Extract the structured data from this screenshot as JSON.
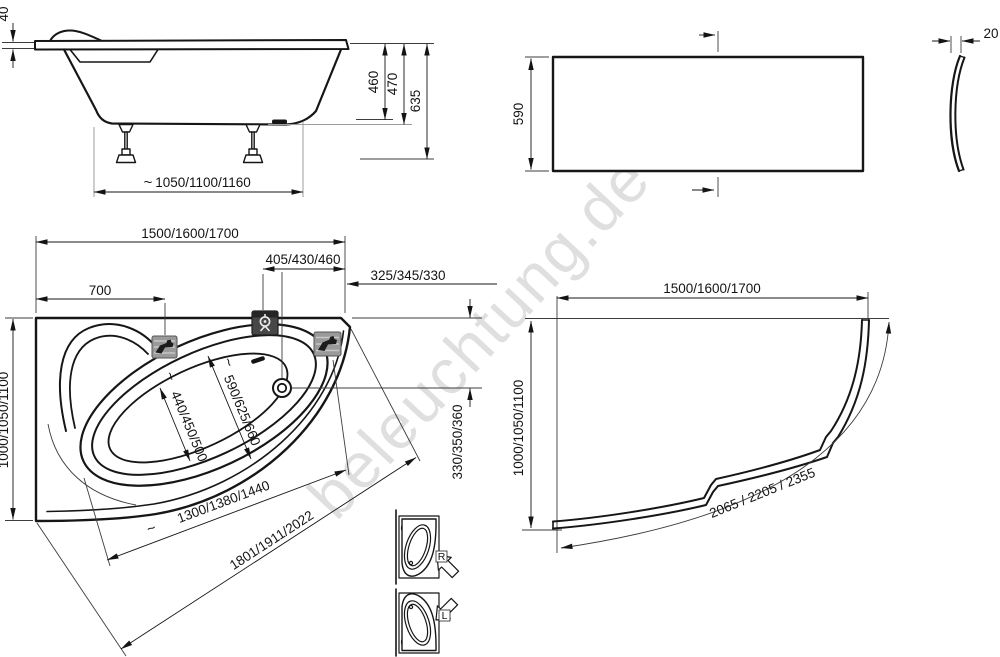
{
  "watermark": {
    "text": "beleuchtung.de"
  },
  "marks": {
    "approx": "~"
  },
  "side_view": {
    "rim_height": "40",
    "depth": "460",
    "shell_height": "470",
    "total_height": "635",
    "feet_span": "1050/1100/1160"
  },
  "front_panel": {
    "height": "590",
    "thickness": "20"
  },
  "top_view": {
    "length": "1500/1600/1700",
    "mixer_offset": "405/430/460",
    "corner_offset": "325/345/330",
    "headrest_offset": "700",
    "width": "1000/1050/1100",
    "drain_offset": "330/350/360",
    "basin_width_seat": "440/450/500",
    "basin_width_drain": "590/625/660",
    "basin_length": "1300/1380/1440",
    "outer_diagonal": "1801/1911/2022",
    "variant_right": "R",
    "variant_left": "L"
  },
  "corner_panel": {
    "length": "1500/1600/1700",
    "width": "1000/1050/1100",
    "curve_length": "2065 / 2205 / 2355"
  }
}
